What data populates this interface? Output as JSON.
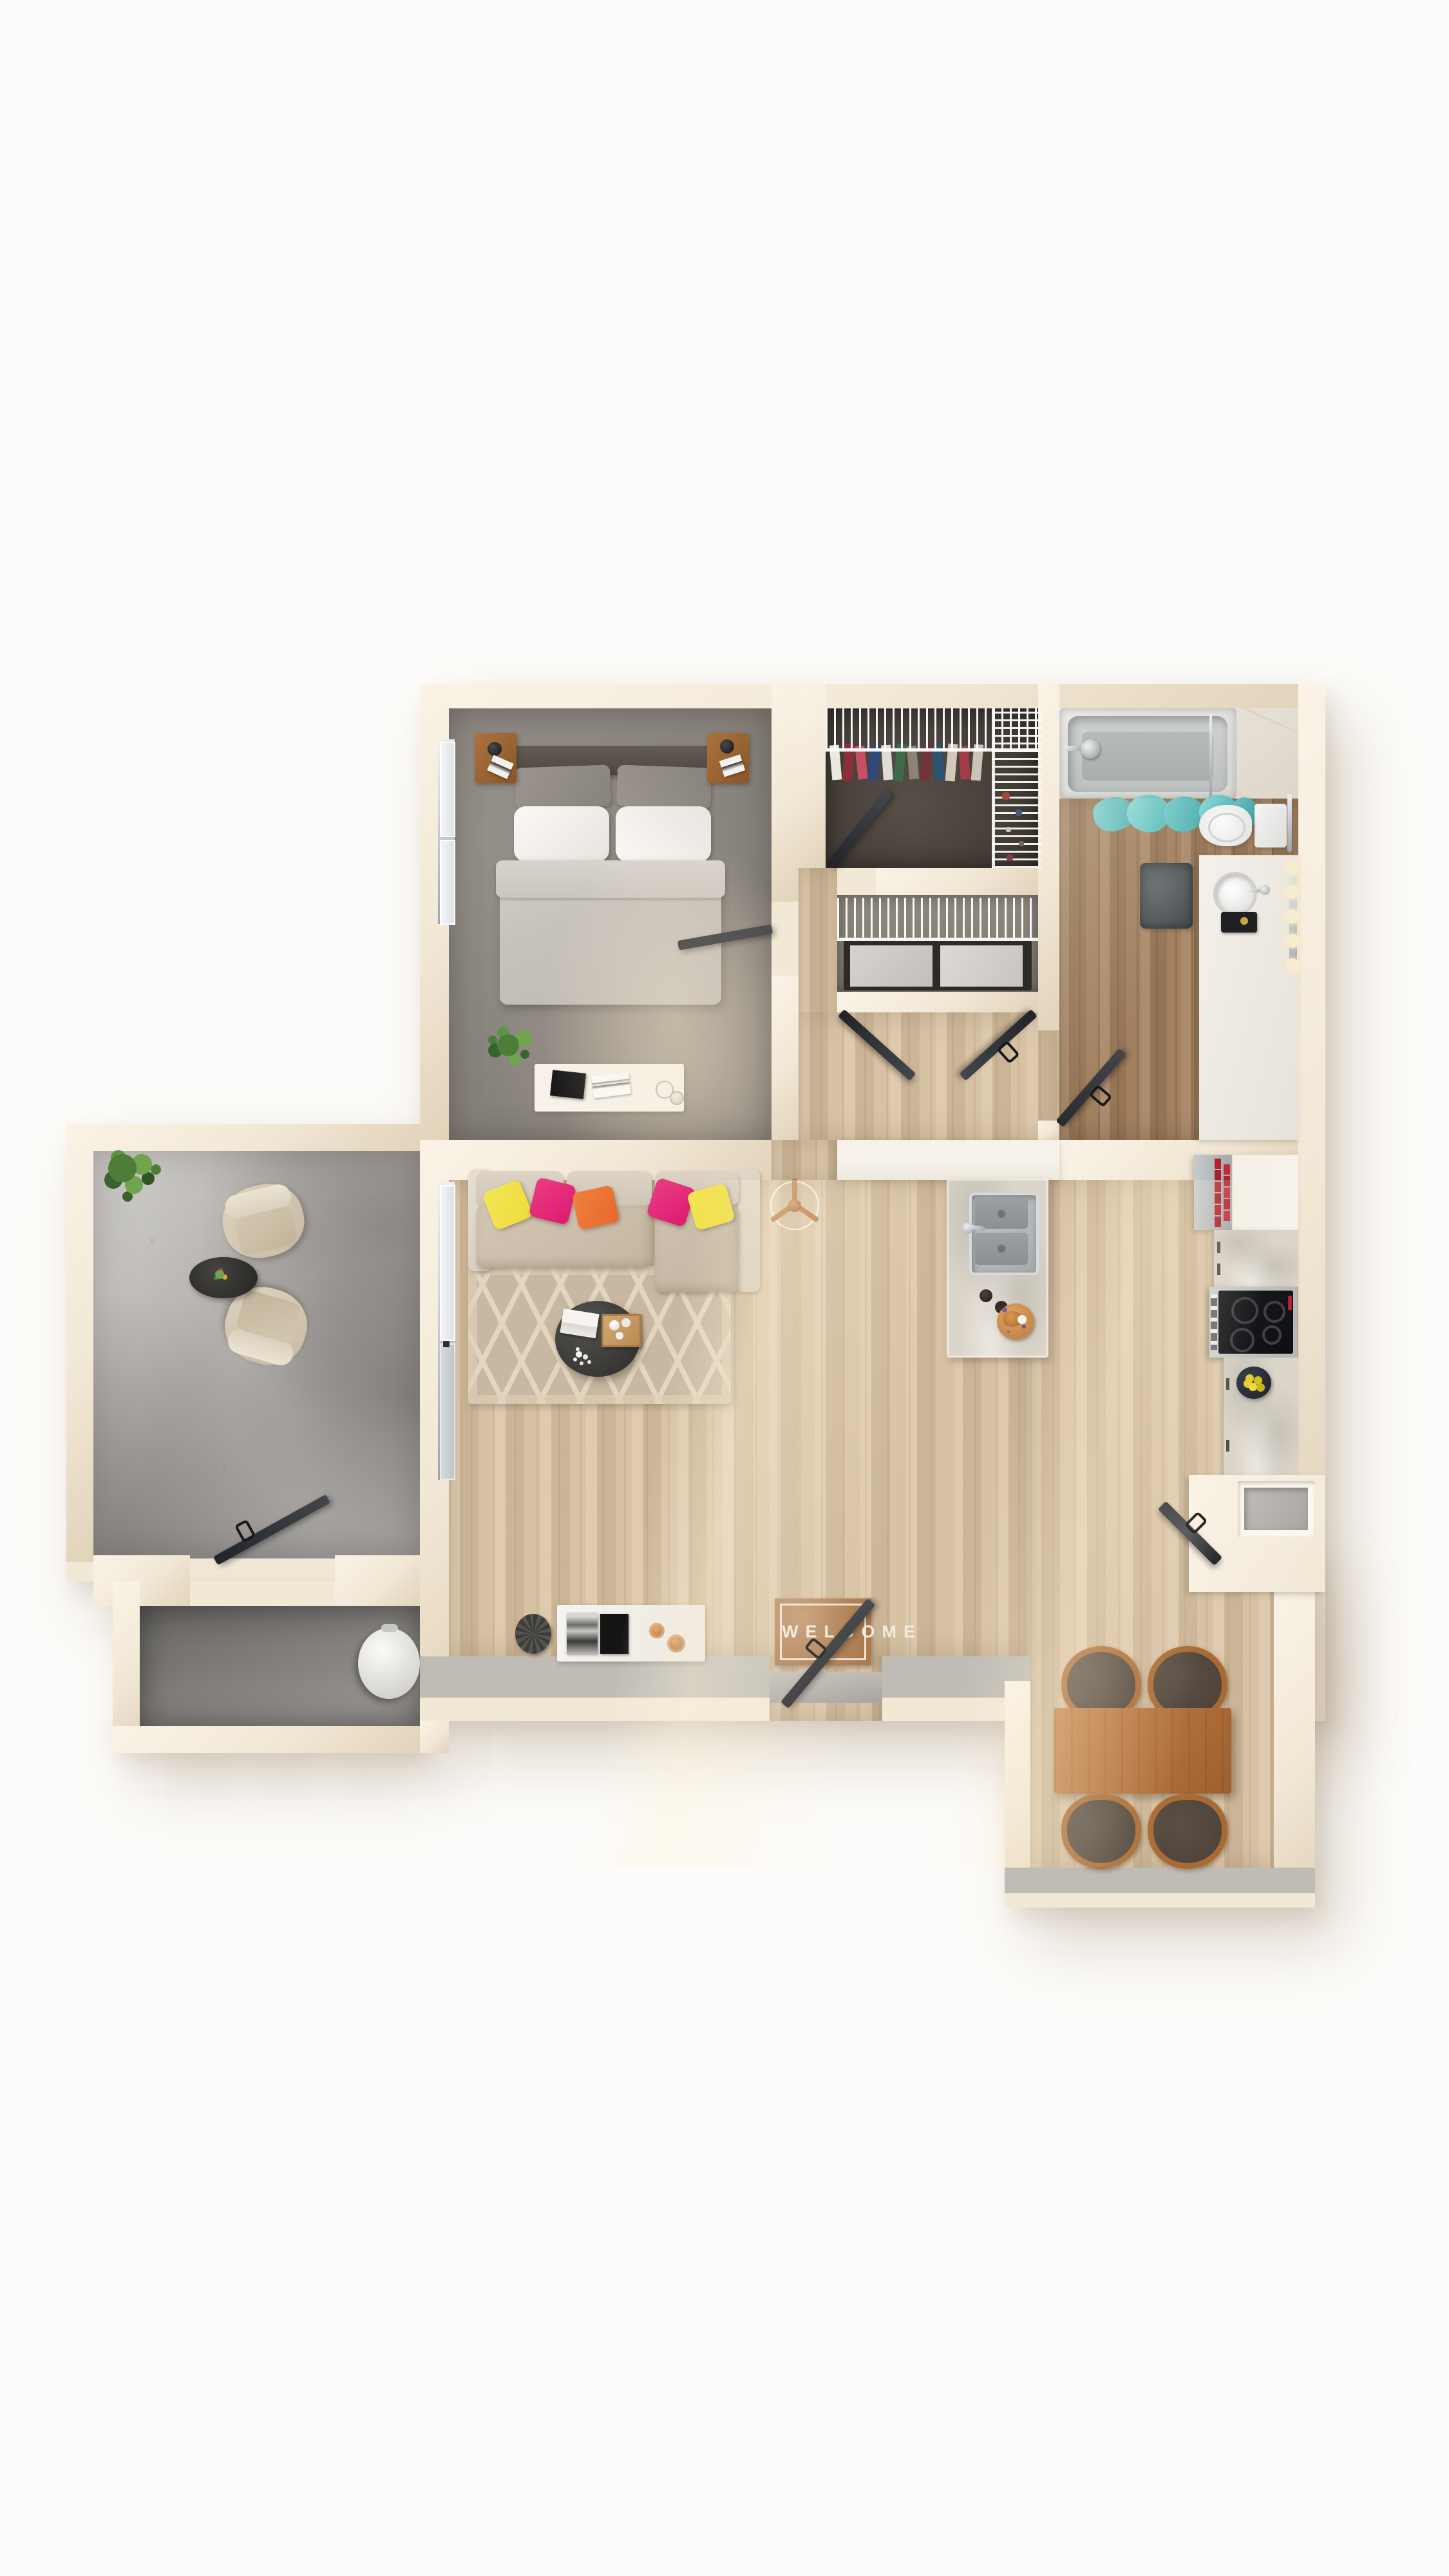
{
  "meta": {
    "description": "Photorealistic top-down 3D rendering of a one-bedroom apartment floor plan on a white background",
    "view": "top-down"
  },
  "welcome_mat": {
    "text": "WELCOME"
  },
  "rooms": [
    {
      "id": "bedroom",
      "name": "Bedroom",
      "floor": "gray carpet"
    },
    {
      "id": "walk-in-closet",
      "name": "Walk-in closet",
      "floor": "dark carpet"
    },
    {
      "id": "laundry-closet",
      "name": "Laundry closet",
      "floor": "wire shelf over washer and dryer"
    },
    {
      "id": "bathroom",
      "name": "Bathroom",
      "floor": "warm wood"
    },
    {
      "id": "hallway",
      "name": "Hallway",
      "floor": "light wood"
    },
    {
      "id": "living-room",
      "name": "Living room",
      "floor": "light wood"
    },
    {
      "id": "kitchen",
      "name": "Kitchen",
      "floor": "light wood"
    },
    {
      "id": "dining-area",
      "name": "Dining area",
      "floor": "light wood"
    },
    {
      "id": "patio",
      "name": "Patio / balcony",
      "floor": "concrete"
    },
    {
      "id": "storage",
      "name": "Outdoor storage",
      "floor": "concrete"
    }
  ],
  "furniture": {
    "bedroom": [
      "queen bed with gray duvet and white pillows",
      "two wood nightstands with black lamps",
      "white dresser with books and dishes",
      "potted plant",
      "two windows"
    ],
    "closet": [
      "wire shelving with hanging clothes",
      "side wire shoe rack"
    ],
    "laundry": [
      "wire shelf",
      "washer",
      "dryer",
      "double doors"
    ],
    "bathroom": [
      "bathtub with chrome shower head",
      "teal shower curtain",
      "toilet with towel bar",
      "dark gray bath mat",
      "white vanity with round sink and five vanity bulbs"
    ],
    "living": [
      "beige sectional sofa with chaise",
      "yellow, magenta and orange throw pillows",
      "lattice-pattern beige rug",
      "round dark coffee table with books, tray and flowers",
      "copper tripod floor lamp",
      "white console with frames and candles",
      "dark decorative plate",
      "welcome door mat",
      "window and sliding patio door"
    ],
    "kitchen": [
      "marble island with stainless double sink",
      "espresso cups and pastry plate",
      "stainless refrigerator with red bottles",
      "electric range with black cooktop",
      "bowl of lemons",
      "corner counter with open oven door",
      "gray wall niche",
      "peninsula counter"
    ],
    "dining": [
      "rectangular wood dining table",
      "four wood chairs with dark seats"
    ],
    "patio": [
      "two wicker lounge chairs",
      "round dark side table with plant",
      "leafy potted plant",
      "storage swing door"
    ],
    "storage": [
      "large white vase"
    ]
  },
  "colors": {
    "bg": "#fdfcfa",
    "wall": "#f2e8d6",
    "wallLight": "#faf3e6",
    "wallEdge": "#e2d3ba",
    "wallTopGray": "#bfbcb6",
    "white": "#f6f2ea",
    "wood": "#d8c2a4",
    "woodBath": "#a28060",
    "carpet": "#8d8781",
    "closetCarpet": "#4e463d",
    "concrete": "#b2afac",
    "concreteDark": "#8a8783",
    "marble": "#dbd5ca",
    "steel": "#aeb3b6",
    "black": "#26262a",
    "sofaBack": "#d8cfc1",
    "sofaSeat": "#cdc1ae",
    "sofaArm": "#e0d7c8",
    "rug": "#c9b8a1",
    "rugLine": "#e2d6c0",
    "pillowYellow": "#eedc3c",
    "pillowMagenta": "#dd1a6e",
    "pillowOrange": "#e8682a",
    "tableDark": "#38373*5",
    "woodFurn": "#a96a33",
    "diningTable": "#b06f3a",
    "chairSeat": "#4b4138",
    "teal": "#60c0c1",
    "matBrown": "#ab7a4f",
    "matText": "#f1eadf",
    "plant": "#4e7d37",
    "plantLight": "#6fa54e",
    "copper": "#b5713c",
    "lemon": "#e3cf2e",
    "redBottle": "#b3212b",
    "bulb": "#f7ecd0",
    "tub": "#e3e2df",
    "tubInner": "#c3c7c6",
    "bathMat": "#555b5d",
    "glass": "#cdd3d3"
  }
}
